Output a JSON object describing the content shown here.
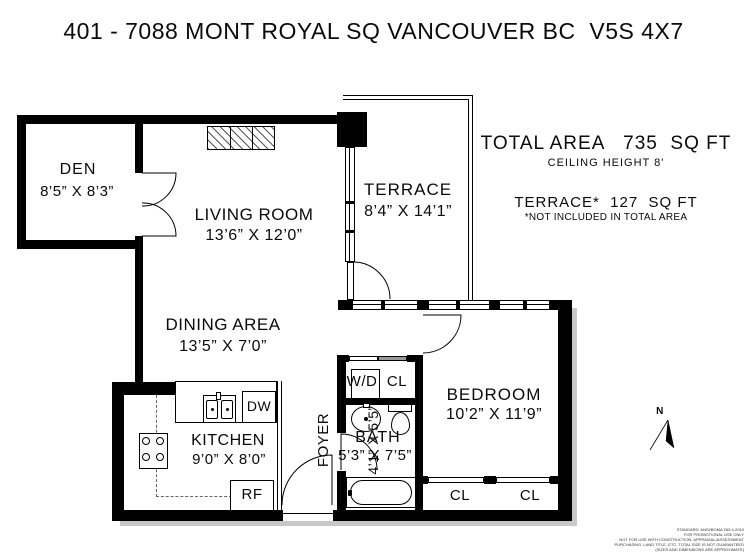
{
  "title": "401 - 7088 MONT ROYAL SQ VANCOUVER BC  V5S 4X7",
  "summary": {
    "total_area": "TOTAL AREA   735  SQ FT",
    "ceiling": "CEILING HEIGHT 8'",
    "terrace_area": "TERRACE*  127  SQ FT",
    "terrace_note": "*NOT INCLUDED IN TOTAL AREA"
  },
  "rooms": {
    "den": {
      "name": "DEN",
      "dims": "8’5” X 8’3”"
    },
    "living": {
      "name": "LIVING ROOM",
      "dims": "13’6” X 12’0”"
    },
    "terrace": {
      "name": "TERRACE",
      "dims": "8’4” X 14’1”"
    },
    "dining": {
      "name": "DINING AREA",
      "dims": "13’5” X 7’0”"
    },
    "kitchen": {
      "name": "KITCHEN",
      "dims": "9’0” X 8’0”"
    },
    "foyer": {
      "name": "FOYER",
      "dims": "4’1” X 5’5”"
    },
    "bath": {
      "name": "BATH",
      "dims": "5’3” X 7’5”"
    },
    "bedroom": {
      "name": "BEDROOM",
      "dims": "10’2” X 11’9”"
    }
  },
  "fixtures": {
    "dishwasher": "DW",
    "refrigerator": "RF",
    "washer_dryer": "W/D",
    "washer_closet": "CL",
    "closet_left": "CL",
    "closet_right": "CL"
  },
  "compass": {
    "north": "N"
  },
  "fineprint": [
    "STANDARD: ANSI/BOMA Z65.4-2010",
    "FOR PROMOTIONAL USE ONLY",
    "NOT FOR USE WITH CONSTRUCTION, APPRAISAL/ASSESSMENT",
    "PURCHASING, LAND TITLE, ETC. TOTAL SIZE IS NOT GUARANTEED",
    "(SIZES AND DIMENSIONS ARE APPROXIMATE)"
  ],
  "colors": {
    "wall": "#000000",
    "background": "#ffffff"
  }
}
